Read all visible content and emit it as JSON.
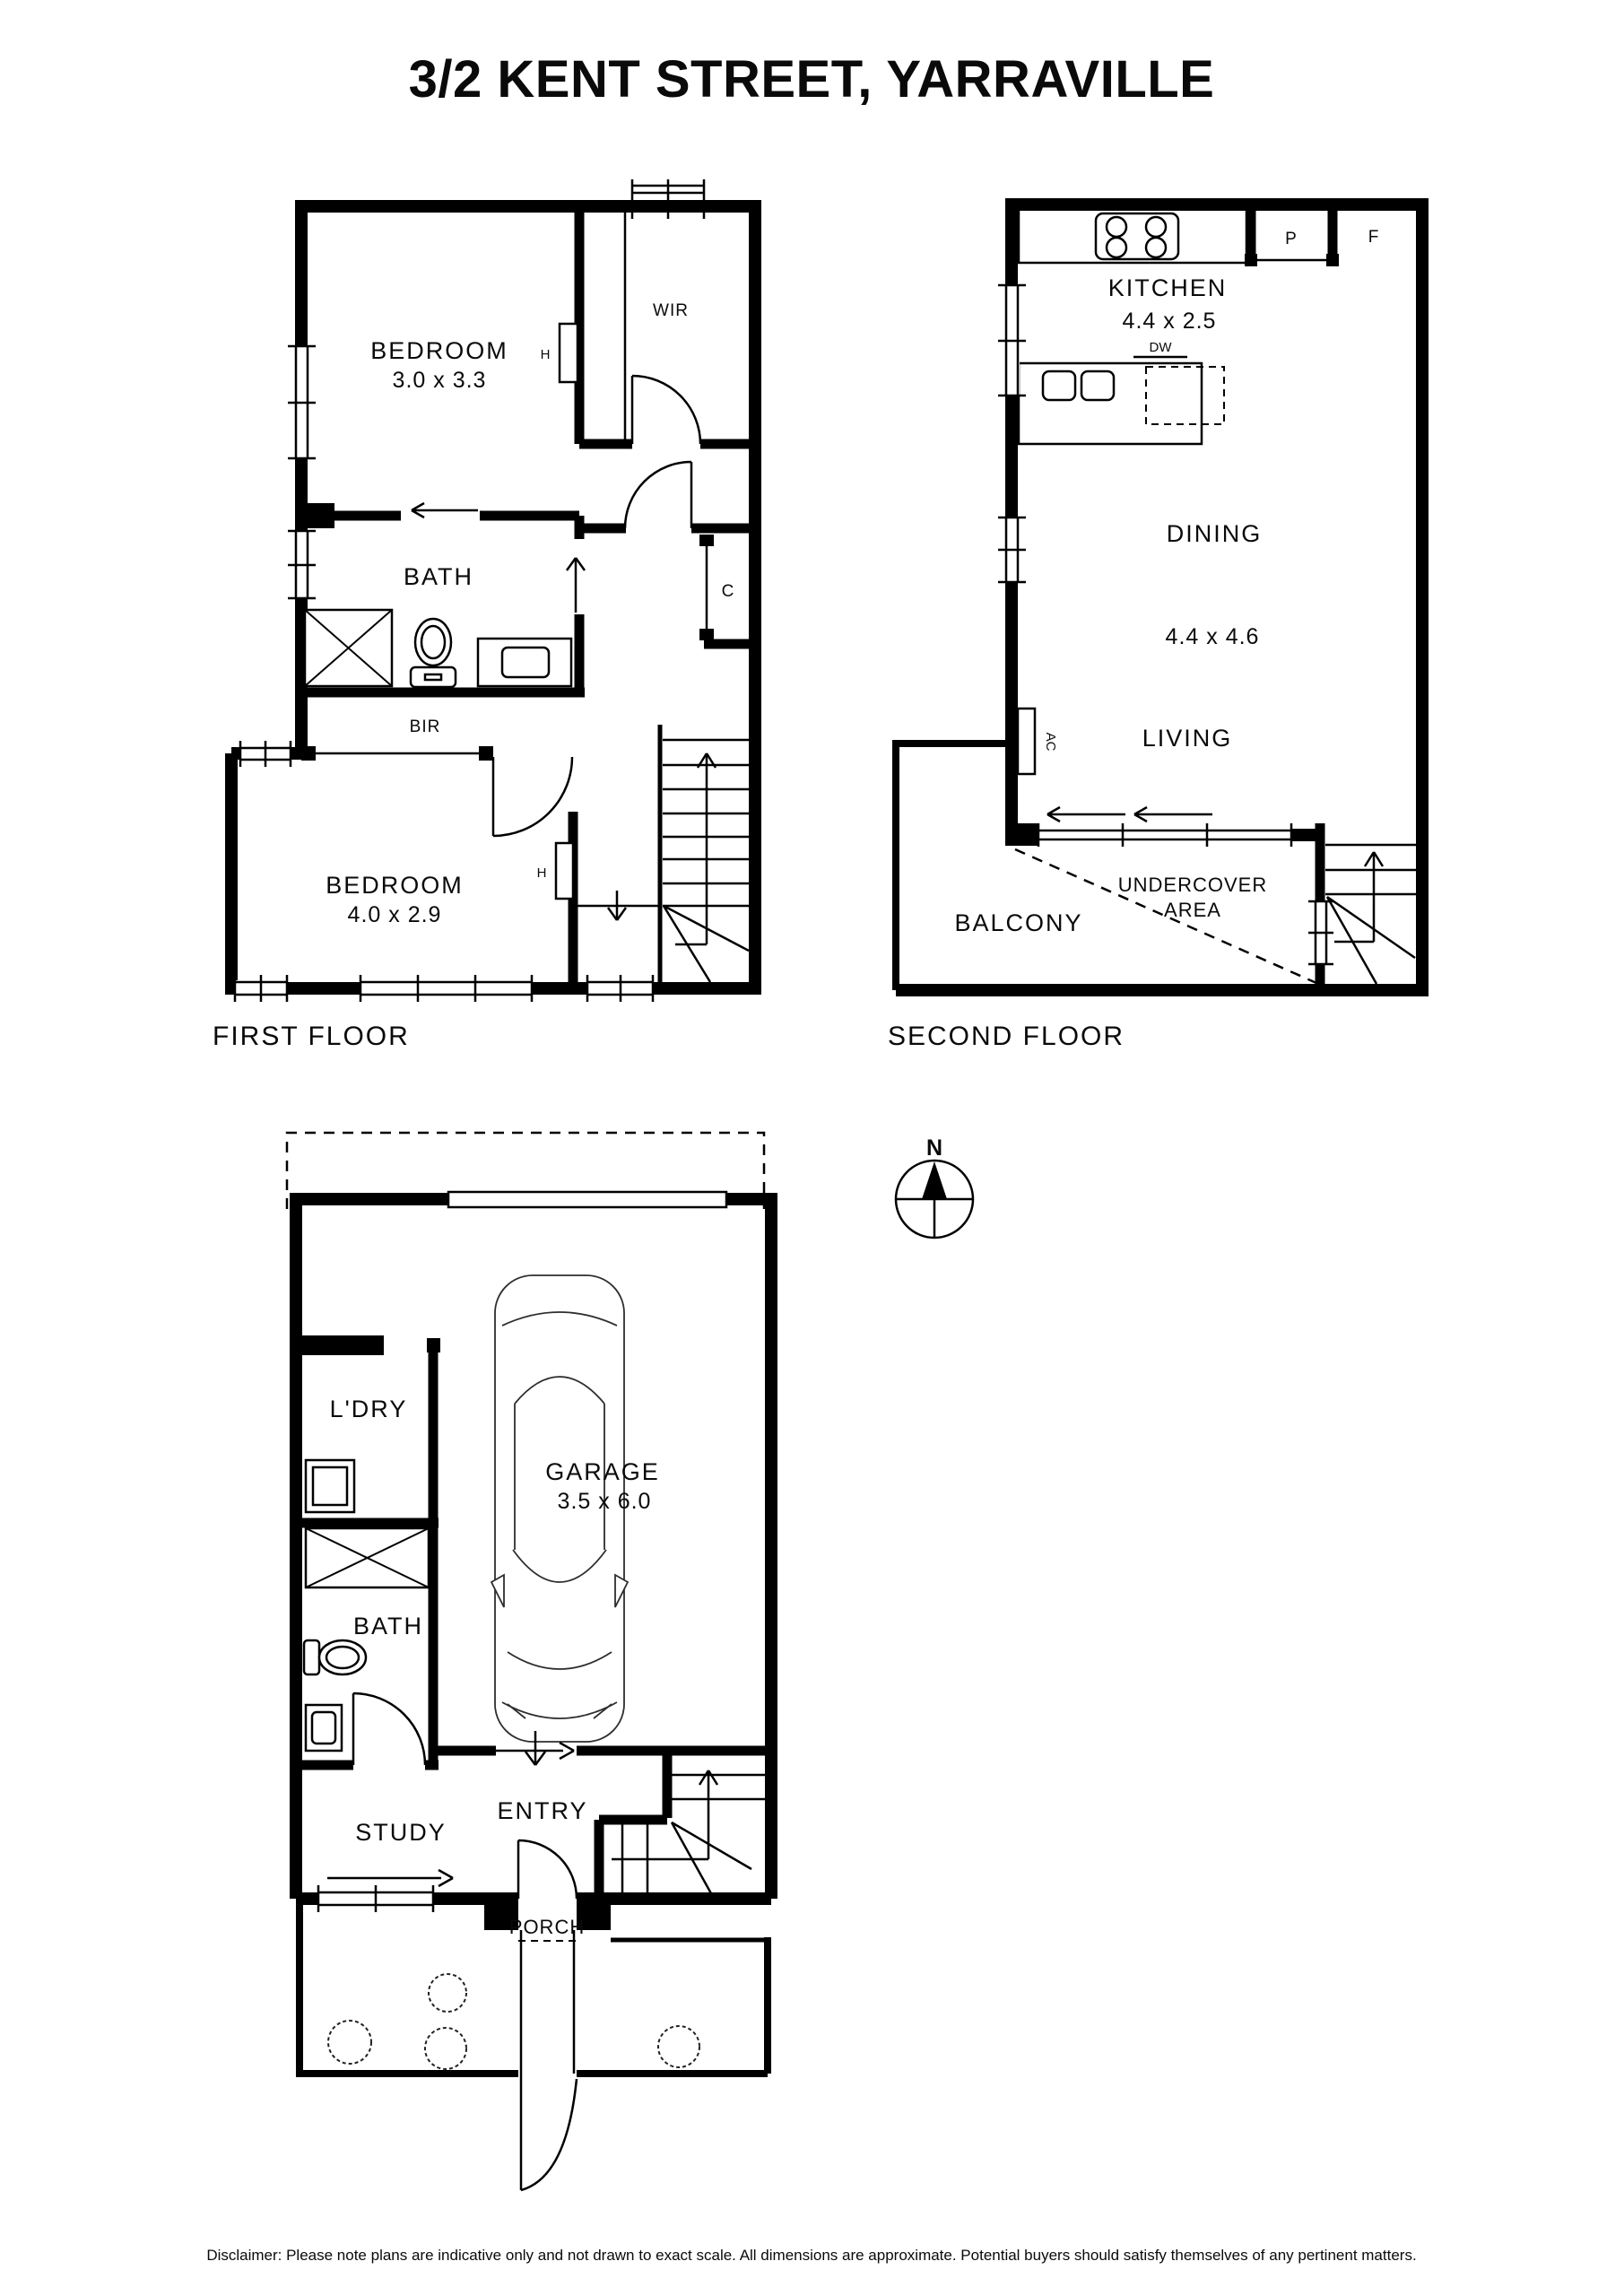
{
  "title": "3/2 KENT STREET, YARRAVILLE",
  "disclaimer": "Disclaimer: Please note plans are indicative only and not drawn to exact scale. All dimensions are approximate. Potential buyers should satisfy themselves of any pertinent matters.",
  "compass": {
    "north_label": "N"
  },
  "first_floor": {
    "label": "FIRST FLOOR",
    "bedroom1": {
      "name": "BEDROOM",
      "dims": "3.0 x 3.3"
    },
    "wir": "WIR",
    "hanging": "H",
    "bath": "BATH",
    "bir": "BIR",
    "cupboard": "C",
    "bedroom2": {
      "name": "BEDROOM",
      "dims": "4.0 x 2.9"
    }
  },
  "second_floor": {
    "label": "SECOND FLOOR",
    "kitchen": {
      "name": "KITCHEN",
      "dims": "4.4 x 2.5"
    },
    "pantry": "P",
    "fridge": "F",
    "dishwasher": "DW",
    "dining": "DINING",
    "living_dining_dims": "4.4 x 4.6",
    "living": "LIVING",
    "ac": "AC",
    "undercover_line1": "UNDERCOVER",
    "undercover_line2": "AREA",
    "balcony": "BALCONY"
  },
  "ground_floor": {
    "laundry": "L'DRY",
    "garage": {
      "name": "GARAGE",
      "dims": "3.5 x 6.0"
    },
    "bath": "BATH",
    "study": "STUDY",
    "entry": "ENTRY",
    "porch": "PORCH"
  }
}
